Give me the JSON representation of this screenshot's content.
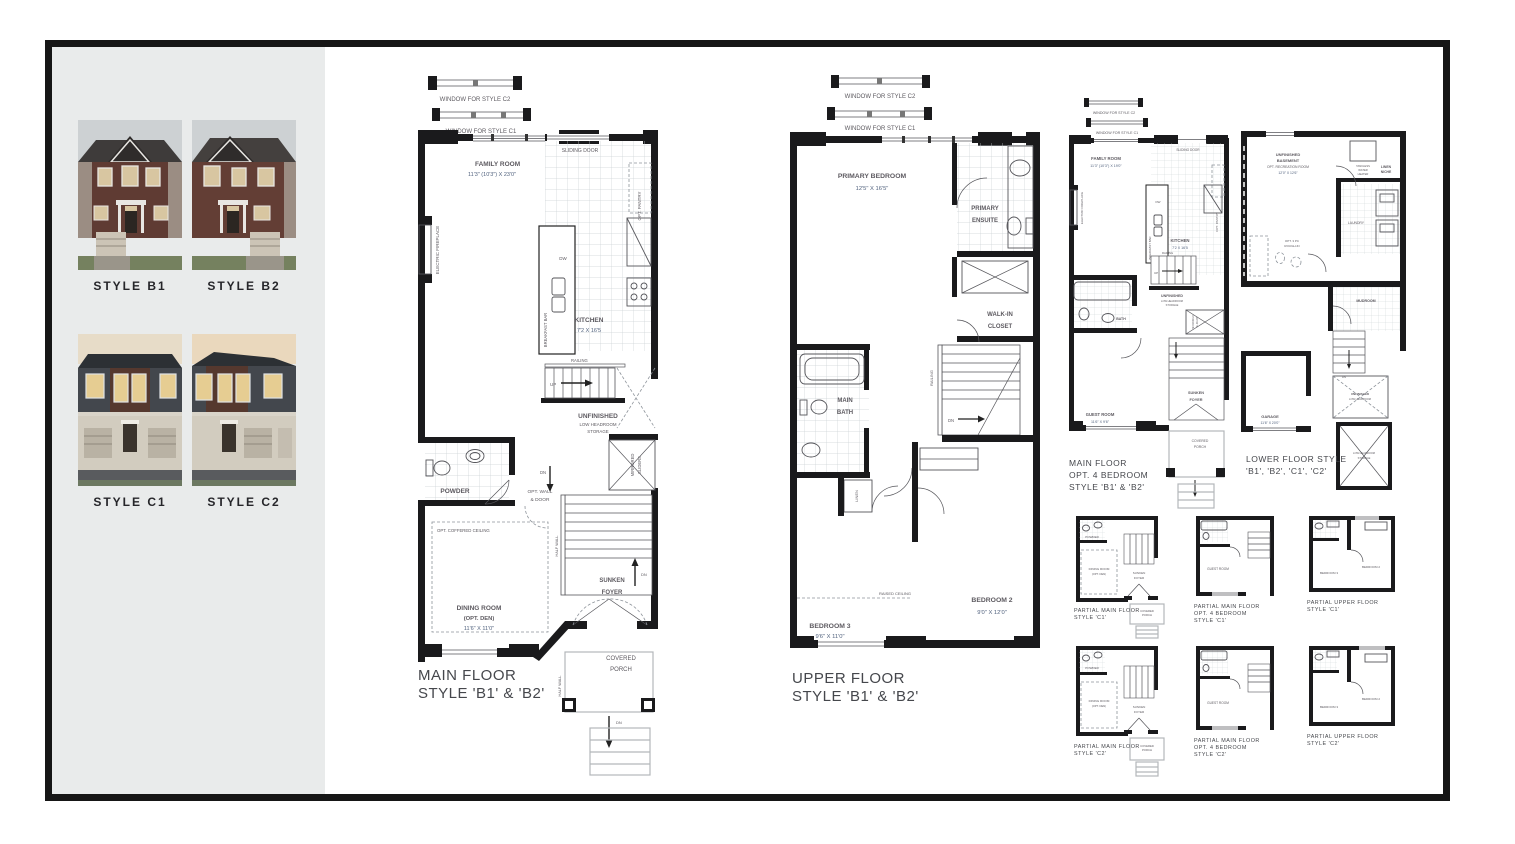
{
  "sidebar": {
    "styles": [
      {
        "label": "STYLE B1"
      },
      {
        "label": "STYLE B2"
      },
      {
        "label": "STYLE C1"
      },
      {
        "label": "STYLE C2"
      }
    ]
  },
  "windows": {
    "c2": "WINDOW FOR STYLE C2",
    "c1": "WINDOW FOR STYLE C1"
  },
  "main_floor": {
    "title1": "MAIN FLOOR",
    "title2": "STYLE 'B1' & 'B2'",
    "family_room": "FAMILY ROOM",
    "family_room_dim": "11'3\" (10'3\") X 23'0\"",
    "sliding_door": "SLIDING DOOR",
    "opt_pantry": "OPT. PANTRY",
    "electric_fireplace": "ELECTRIC FIREPLACE",
    "breakfast_bar": "BREAKFAST BAR",
    "dw": "DW",
    "kitchen": "KITCHEN",
    "kitchen_dim": "7'2 X 16'5",
    "railing": "RAILING",
    "up": "UP",
    "dn": "DN",
    "unfinished": "UNFINISHED",
    "low_headroom": "LOW HEADROOM",
    "storage": "STORAGE",
    "mirrored": "MIRRORED",
    "sliders": "SLIDERS",
    "powder": "POWDER",
    "opt_wall": "OPT. WALL",
    "amp_door": "& DOOR",
    "opt_coffered": "OPT. COFFERED CEILING",
    "dining_room": "DINING ROOM",
    "dining_opt": "(OPT. DEN)",
    "dining_dim": "11'6\" X 11'0\"",
    "half_wall": "HALF WALL",
    "sunken": "SUNKEN",
    "foyer": "FOYER",
    "covered": "COVERED",
    "porch": "PORCH"
  },
  "upper_floor": {
    "title1": "UPPER FLOOR",
    "title2": "STYLE 'B1' & 'B2'",
    "primary_bedroom": "PRIMARY BEDROOM",
    "primary_bedroom_dim": "12'5\" X 16'5\"",
    "primary": "PRIMARY",
    "ensuite": "ENSUITE",
    "walkin": "WALK-IN",
    "closet": "CLOSET",
    "main": "MAIN",
    "bath": "BATH",
    "railing": "RAILING",
    "dn": "DN",
    "linen": "LINEN",
    "raised_ceiling": "RAISED CEILING",
    "bedroom2": "BEDROOM 2",
    "bedroom2_dim": "9'0\" X 12'0\"",
    "bedroom3": "BEDROOM 3",
    "bedroom3_dim": "9'6\" X 11'0\""
  },
  "opt4_floor": {
    "title1": "MAIN FLOOR",
    "title2": "OPT. 4 BEDROOM",
    "title3": "STYLE 'B1' & 'B2'",
    "family_room": "FAMILY ROOM",
    "family_room_dim": "11'3\" (10'3\") X 19'0\"",
    "sliding_door": "SLIDING DOOR",
    "kitchen": "KITCHEN",
    "kitchen_dim": "7'2 X 16'5",
    "bath": "BATH",
    "guest_room": "GUEST ROOM",
    "guest_room_dim": "11'6\" X 9'6\"",
    "sunken": "SUNKEN",
    "foyer": "FOYER",
    "covered": "COVERED",
    "porch": "PORCH",
    "up": "UP",
    "dn": "DN",
    "dw": "DW",
    "railing": "RAILING",
    "unfinished": "UNFINISHED",
    "low_headroom": "LOW HEADROOM",
    "storage": "STORAGE",
    "electric_fireplace": "ELECTRIC FIREPLACE",
    "opt_pantry": "OPT. PANTRY",
    "breakfast_bar": "BREAKFAST BAR",
    "mirrored": "MIRRORED",
    "sliders": "SLIDERS"
  },
  "lower_floor": {
    "title1": "LOWER FLOOR STYLE",
    "title2": "'B1', 'B2', 'C1', 'C2'",
    "unfinished": "UNFINISHED",
    "basement": "BASEMENT",
    "opt_rec": "OPT. RECREATION ROOM",
    "rec_dim": "12'0\" X 12'6\"",
    "tankless1": "TANKLESS",
    "tankless2": "WATER",
    "tankless3": "HEATER",
    "linen": "LINEN",
    "niche": "NICHE",
    "laundry": "LAUNDRY",
    "opt3pc": "OPT. 3 PC",
    "roughin": "ROUGH-IN",
    "mudroom": "MUDROOM",
    "garage": "GARAGE",
    "garage_dim": "11'6\" X 20'0\"",
    "low_headroom": "LOW HEADROOM",
    "storage": "STORAGE",
    "dn": "DN"
  },
  "partials": [
    {
      "t1": "PARTIAL MAIN FLOOR",
      "t2": "STYLE 'C1'"
    },
    {
      "t1": "PARTIAL MAIN FLOOR",
      "t2": "OPT. 4 BEDROOM",
      "t3": "STYLE 'C1'"
    },
    {
      "t1": "PARTIAL UPPER FLOOR",
      "t2": "STYLE 'C1'"
    },
    {
      "t1": "PARTIAL MAIN FLOOR",
      "t2": "STYLE 'C2'"
    },
    {
      "t1": "PARTIAL MAIN FLOOR",
      "t2": "OPT. 4 BEDROOM",
      "t3": "STYLE 'C2'"
    },
    {
      "t1": "PARTIAL UPPER FLOOR",
      "t2": "STYLE 'C2'"
    }
  ],
  "partial_labels": {
    "powder": "POWDER",
    "dining": "DINING ROOM",
    "opt_den": "(OPT. DEN)",
    "sunken": "SUNKEN",
    "foyer": "FOYER",
    "covered": "COVERED",
    "porch": "PORCH",
    "guest_room": "GUEST ROOM",
    "bath": "BATH",
    "main_bath": "MAIN BATH",
    "bedroom2": "BEDROOM 2",
    "bedroom3": "BEDROOM 3"
  },
  "colors": {
    "frame": "#161616",
    "sidebar_bg": "#e9ebeb",
    "wall": "#1a1a1c",
    "room_label": "#5d5a60",
    "dimension": "#50617d",
    "title": "#45474c"
  }
}
